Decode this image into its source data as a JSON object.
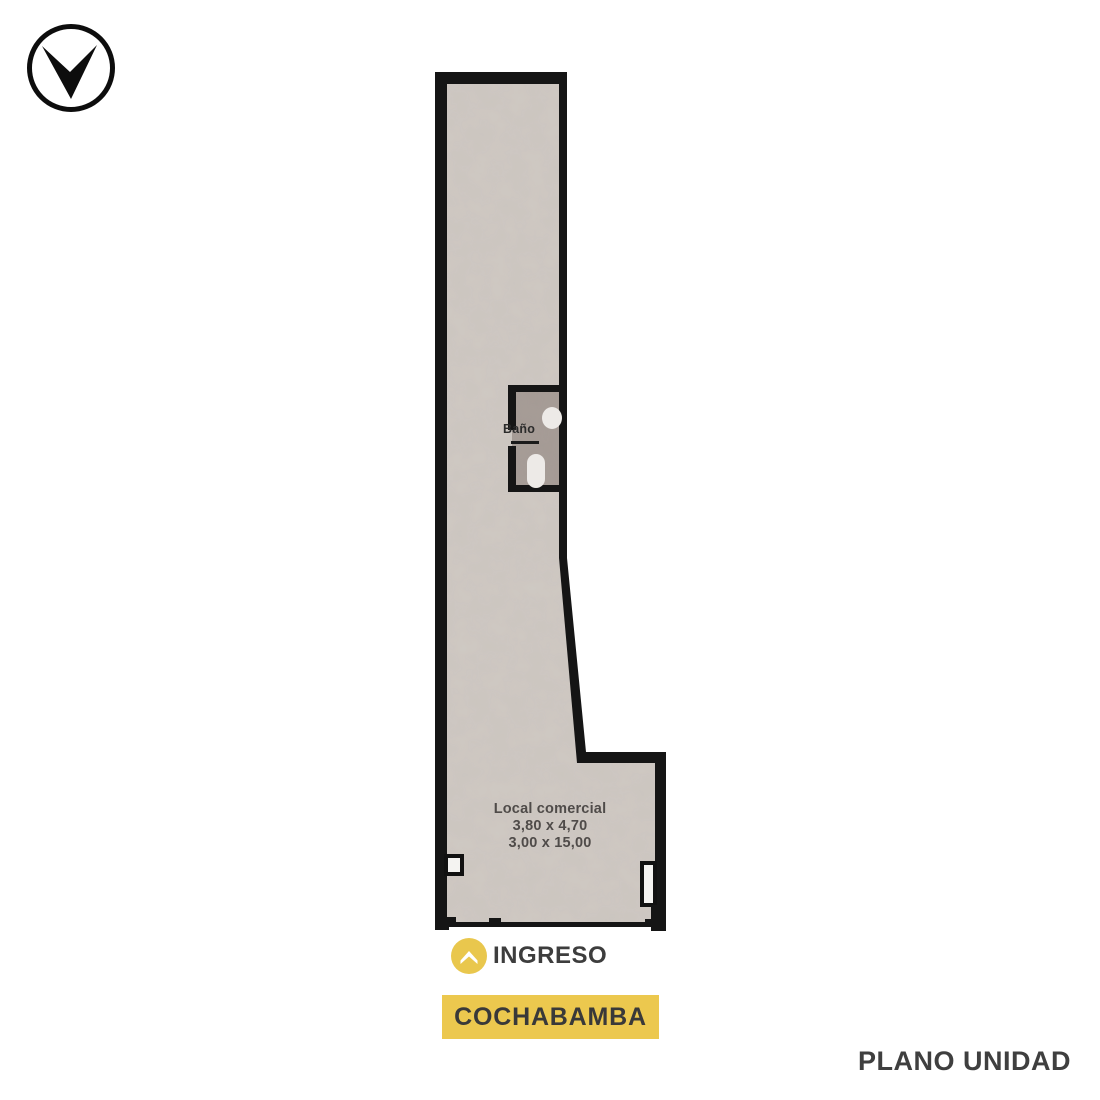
{
  "colors": {
    "background": "#ffffff",
    "wall": "#151515",
    "floor": "#cfc9c3",
    "bathroom_floor": "#a59b95",
    "fixture_white": "#edeae7",
    "accent_yellow": "#ecc84e",
    "text_dark": "#3d3d3d",
    "plan_text": "#4f4b49"
  },
  "logo": {
    "icon": "brand-dart-logo-icon"
  },
  "floorplan": {
    "bathroom_label": "Baño",
    "unit": {
      "line1": "Local comercial",
      "line2": "3,80 x 4,70",
      "line3": "3,00 x 15,00"
    }
  },
  "entrance": {
    "icon": "chevron-up-icon",
    "label": "INGRESO"
  },
  "street_banner": {
    "label": "COCHABAMBA"
  },
  "caption": {
    "label": "PLANO UNIDAD"
  }
}
